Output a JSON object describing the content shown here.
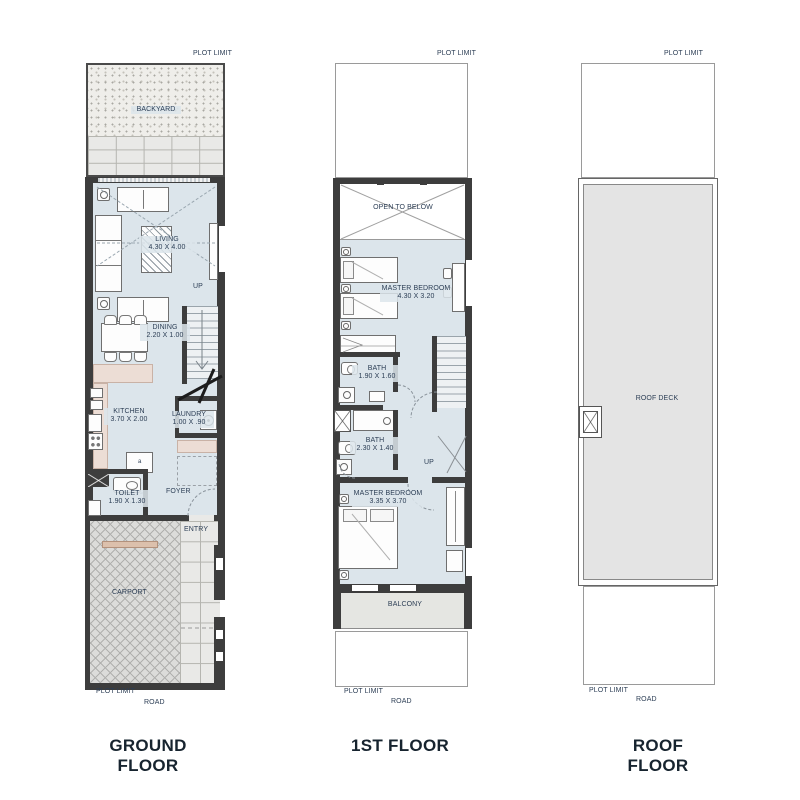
{
  "document": {
    "type": "floor-plan-sheet"
  },
  "captions": {
    "ground": "GROUND FLOOR",
    "first": "1ST FLOOR",
    "roof": "ROOF FLOOR"
  },
  "common": {
    "plot_limit": "PLOT LIMIT",
    "road": "ROAD",
    "up": "UP"
  },
  "ground_floor": {
    "backyard": "BACKYARD",
    "living": {
      "name": "LIVING",
      "dim": "4.30 X 4.00"
    },
    "dining": {
      "name": "DINING",
      "dim": "2.20 X 1.00"
    },
    "kitchen": {
      "name": "KITCHEN",
      "dim": "3.70 X 2.00"
    },
    "laundry": {
      "name": "LAUNDRY",
      "dim": "1.00 X .90"
    },
    "toilet": {
      "name": "TOILET",
      "dim": "1.90 X 1.30"
    },
    "foyer": "FOYER",
    "entry": "ENTRY",
    "carport": "CARPORT",
    "island_mark": "a"
  },
  "first_floor": {
    "open_to_below": "OPEN TO BELOW",
    "master_bedroom_1": {
      "name": "MASTER BEDROOM",
      "dim": "4.30 X 3.20"
    },
    "bath_1": {
      "name": "BATH",
      "dim": "1.90 X 1.60"
    },
    "bath_2": {
      "name": "BATH",
      "dim": "2.30 X 1.40"
    },
    "master_bedroom_2": {
      "name": "MASTER BEDROOM",
      "dim": "3.35 X 3.70"
    },
    "balcony": "BALCONY"
  },
  "roof_floor": {
    "roof_deck": "ROOF DECK"
  },
  "colors": {
    "wall": "#3d3d3d",
    "room_fill": "#dce5eb",
    "counter_fill": "#ecddd5",
    "deck_fill": "#e4e4e4",
    "label_text": "#2c3e55",
    "caption_text": "#17242f"
  }
}
